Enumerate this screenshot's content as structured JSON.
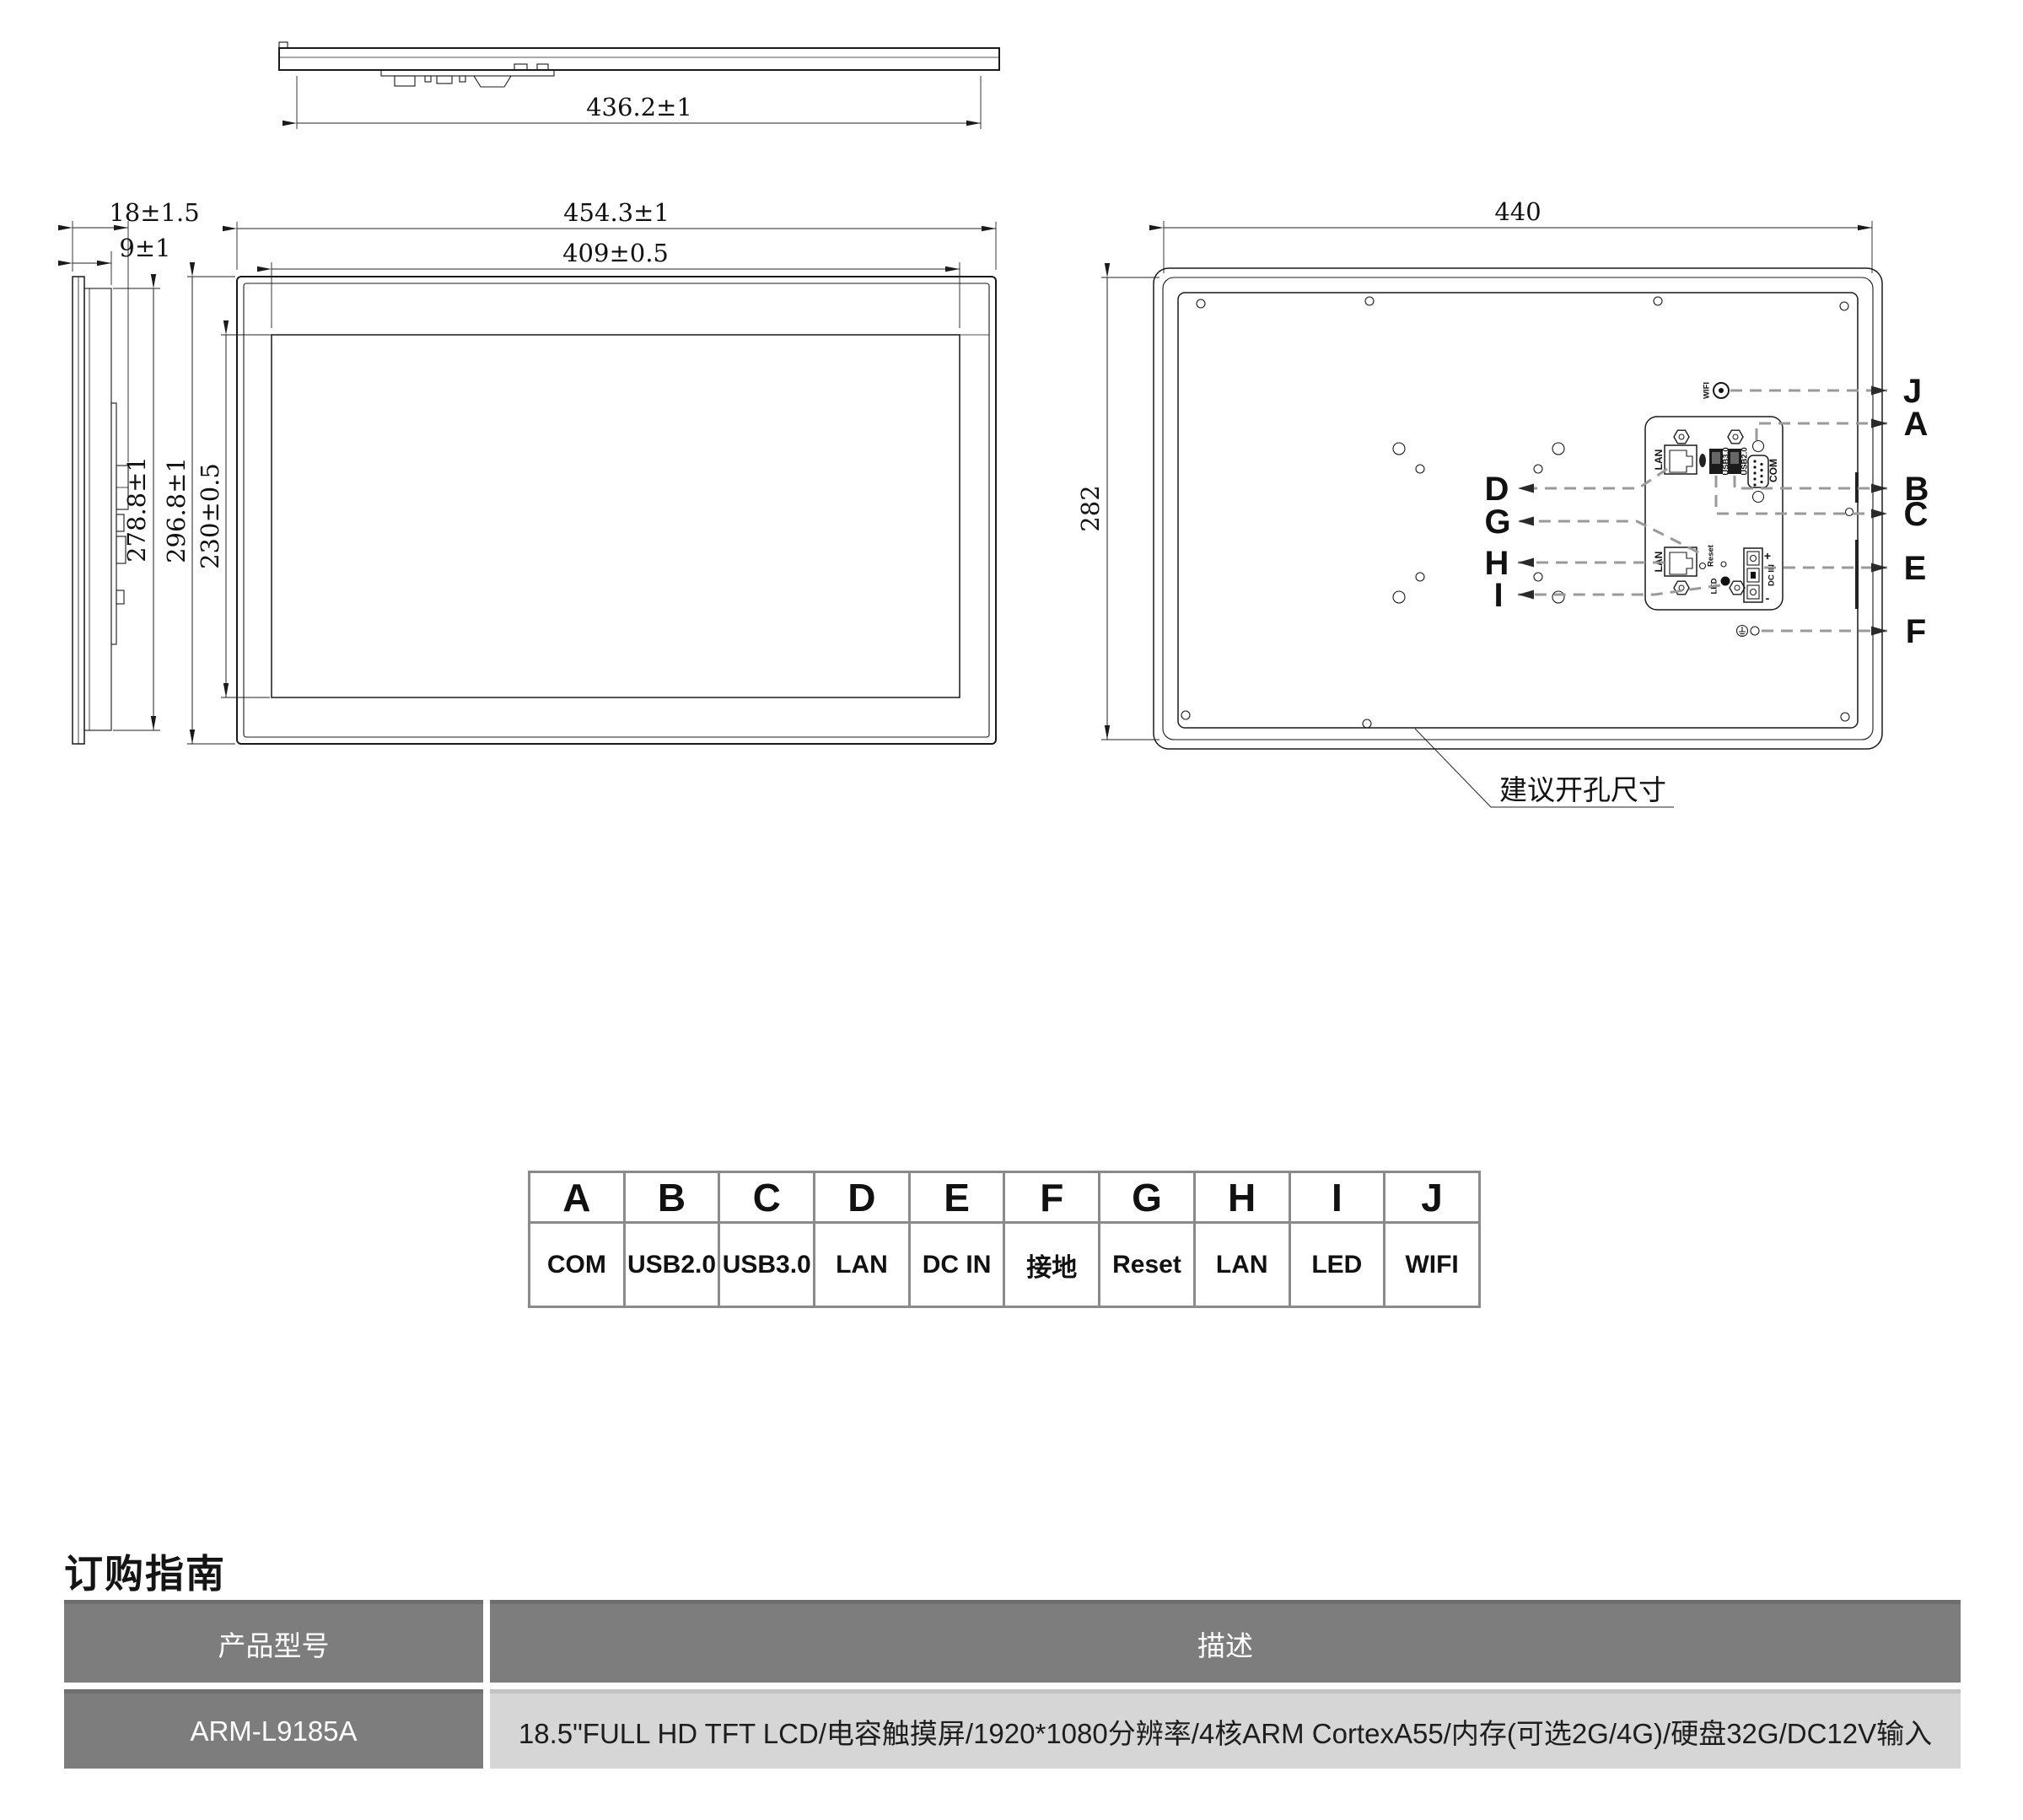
{
  "views": {
    "top_view": {
      "width": "436.2±1"
    },
    "side_view": {
      "total_thickness": "18±1.5",
      "front_thickness": "9±1",
      "body_height": "278.8±1"
    },
    "front_view": {
      "outer_width": "454.3±1",
      "active_width": "409±0.5",
      "outer_height": "296.8±1",
      "active_height": "230±0.5"
    },
    "rear_view": {
      "cutout_width": "440",
      "cutout_height": "282",
      "cutout_note": "建议开孔尺寸",
      "ports": {
        "lan_top": "LAN",
        "usb3": "USB3.0",
        "usb2": "USB2.0",
        "com": "COM",
        "lan_bottom": "LAN",
        "reset": "Reset",
        "led": "LED",
        "dc_in": "DC IN",
        "dc_plus": "+",
        "dc_minus": "-",
        "wifi": "WIFI"
      },
      "callouts_left": [
        "D",
        "G",
        "H",
        "I"
      ],
      "callouts_right": [
        "J",
        "A",
        "B",
        "C",
        "E",
        "F"
      ]
    }
  },
  "legend": {
    "entries": [
      {
        "key": "A",
        "label": "COM"
      },
      {
        "key": "B",
        "label": "USB2.0"
      },
      {
        "key": "C",
        "label": "USB3.0"
      },
      {
        "key": "D",
        "label": "LAN"
      },
      {
        "key": "E",
        "label": "DC IN"
      },
      {
        "key": "F",
        "label": "接地"
      },
      {
        "key": "G",
        "label": "Reset"
      },
      {
        "key": "H",
        "label": "LAN"
      },
      {
        "key": "I",
        "label": "LED"
      },
      {
        "key": "J",
        "label": "WIFI"
      }
    ]
  },
  "ordering": {
    "heading": "订购指南",
    "columns": [
      "产品型号",
      "描述"
    ],
    "rows": [
      {
        "model": "ARM-L9185A",
        "description": "18.5\"FULL HD TFT LCD/电容触摸屏/1920*1080分辨率/4核ARM CortexA55/内存(可选2G/4G)/硬盘32G/DC12V输入"
      }
    ]
  },
  "colors": {
    "line": "#1a1a1a",
    "leader": "#9a9a9a",
    "table_border": "#8a8a8a",
    "table_header_bg": "#7d7d7d",
    "table_cell_bg": "#d6d6d6"
  }
}
